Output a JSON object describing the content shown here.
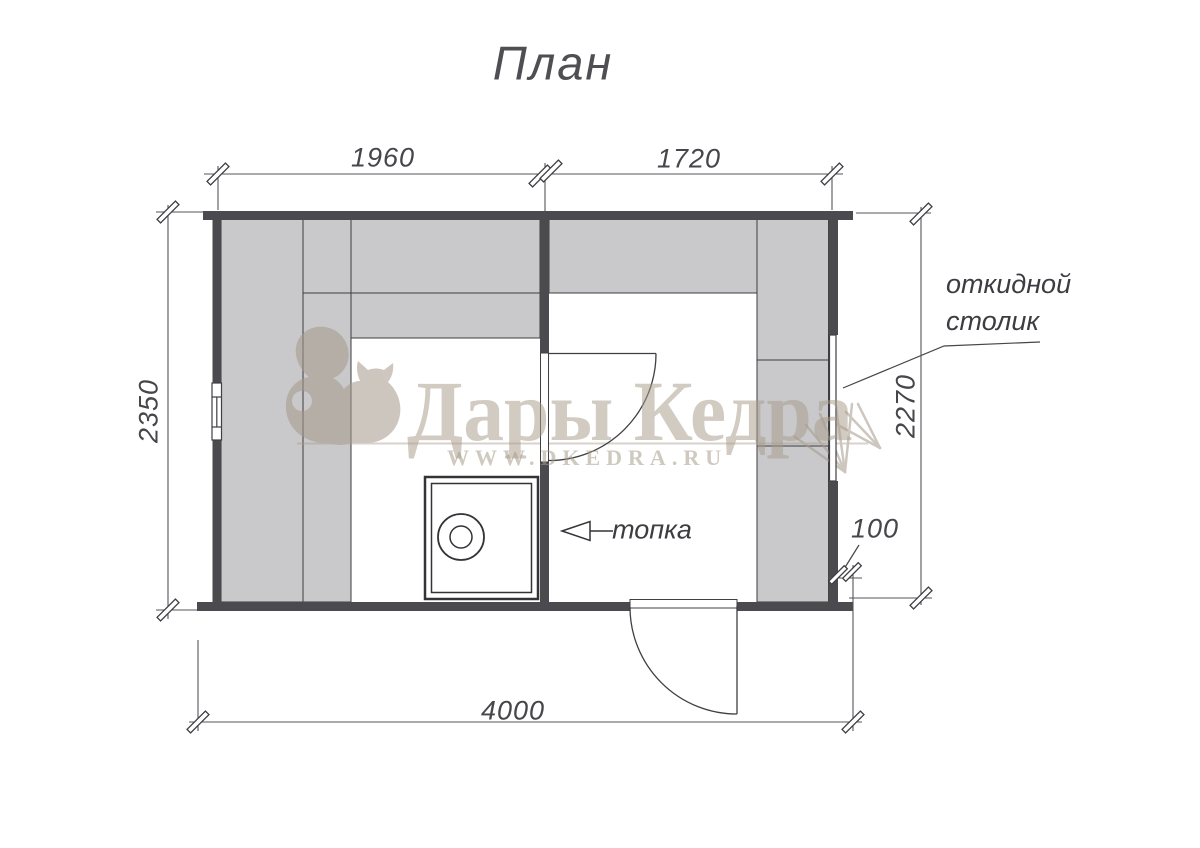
{
  "title": "План",
  "dimensions": {
    "top_left_room_width": "1960",
    "top_right_room_width": "1720",
    "left_height": "2350",
    "right_height": "2270",
    "wall_overhang": "100",
    "total_width": "4000"
  },
  "labels": {
    "folding_table_line1": "откидной",
    "folding_table_line2": "столик",
    "firebox": "топка"
  },
  "watermark": {
    "brand": "Дары Кедра",
    "website": "WWW.DKEDRA.RU"
  },
  "icons": {
    "logo": "squirrel-logo",
    "decoration": "cedar-branch"
  },
  "colors": {
    "wall": "#4b4b4f",
    "bench_fill": "#c9c9cb",
    "line": "#3f3f44",
    "dimension_line": "#55555a",
    "watermark": "#a8998a"
  }
}
